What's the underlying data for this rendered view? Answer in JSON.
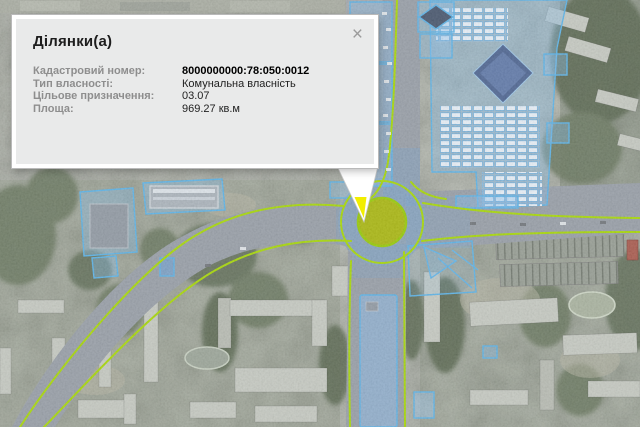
{
  "popup": {
    "title": "Ділянки(а)",
    "close_label": "×",
    "fields": [
      {
        "label": "Кадастровий номер:",
        "value": "8000000000:78:050:0012"
      },
      {
        "label": "Тип власності:",
        "value": "Комунальна власність"
      },
      {
        "label": "Цільове призначення:",
        "value": "03.07"
      },
      {
        "label": "Площа:",
        "value": "969.27 кв.м"
      }
    ]
  },
  "map": {
    "selected_parcel": {
      "cadastral_number": "8000000000:78:050:0012",
      "shape": "roundabout-circle"
    },
    "colors": {
      "road_outline": "#a6d800",
      "parcel_outline": "#58b2e8",
      "parcel_fill": "rgba(130,190,240,0.38)",
      "selected_fill": "#a9b70b",
      "selected_outline": "#95ca00",
      "callout_tip": "#f2ee00"
    }
  }
}
